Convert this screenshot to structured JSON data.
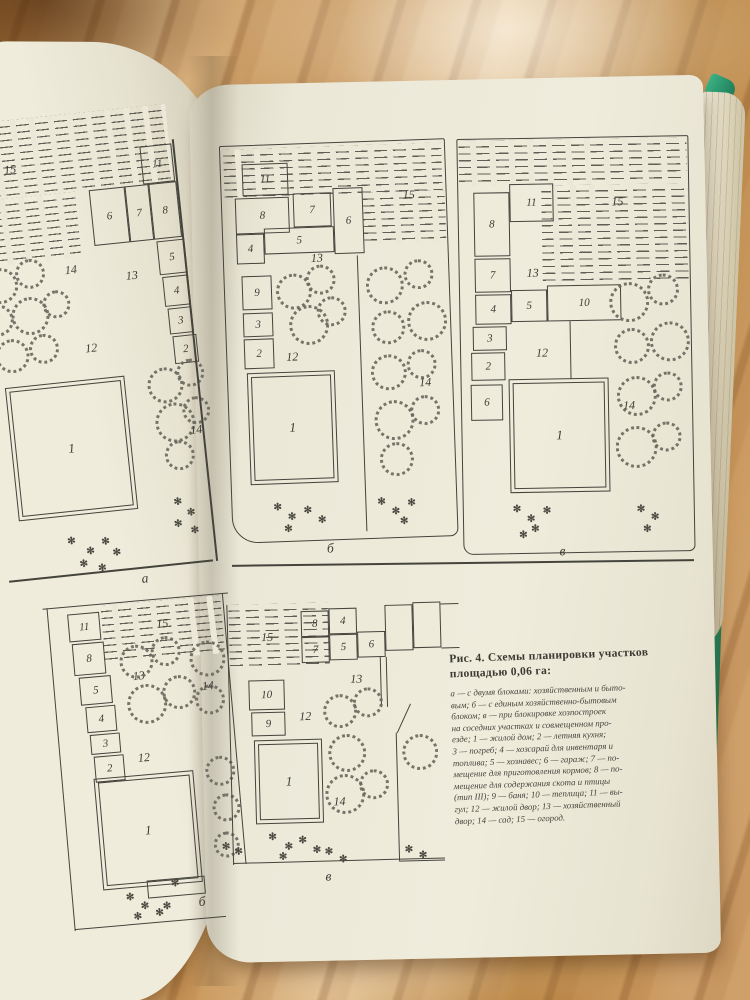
{
  "figure_caption": {
    "title": "Рис. 4. Схемы планировки участков площадью 0,06 га:",
    "body_lines": [
      "а — с двумя блоками: хозяйственным и быто-",
      "вым; б — с единым хозяйственно-бытовым",
      "блоком; в — при блокировке хозпостроек",
      "на соседних участках и совмещенном про-",
      "езде; 1 — жилой дом; 2 — летняя кухня;",
      "3 — погреб; 4 — хозсарай для инвентаря и",
      "топлива; 5 — хознавес; 6 — гараж; 7 — по-",
      "мещение для приготовления кормов; 8 — по-",
      "мещение для содержания скота и птицы",
      "(тип III); 9 — баня; 10 — теплица; 11 — вы-",
      "гул; 12 — жилой двор; 13 — хозяйственный",
      "двор; 14 — сад; 15 — огород."
    ]
  },
  "zones": {
    "1": "1",
    "2": "2",
    "3": "3",
    "4": "4",
    "5": "5",
    "6": "6",
    "7": "7",
    "8": "8",
    "9": "9",
    "10": "10",
    "11": "11",
    "12": "12",
    "13": "13",
    "14": "14",
    "15": "15"
  },
  "diagram_labels": {
    "top_left": "а",
    "top_middle": "б",
    "top_right": "в",
    "bottom_left": "б",
    "bottom_middle": "в"
  },
  "icons": {
    "flower": "✻"
  },
  "colors": {
    "page": "#ebe8d8",
    "ink": "#45443c",
    "wood": "#c99a5e",
    "cover_green": "#2d9c72"
  }
}
